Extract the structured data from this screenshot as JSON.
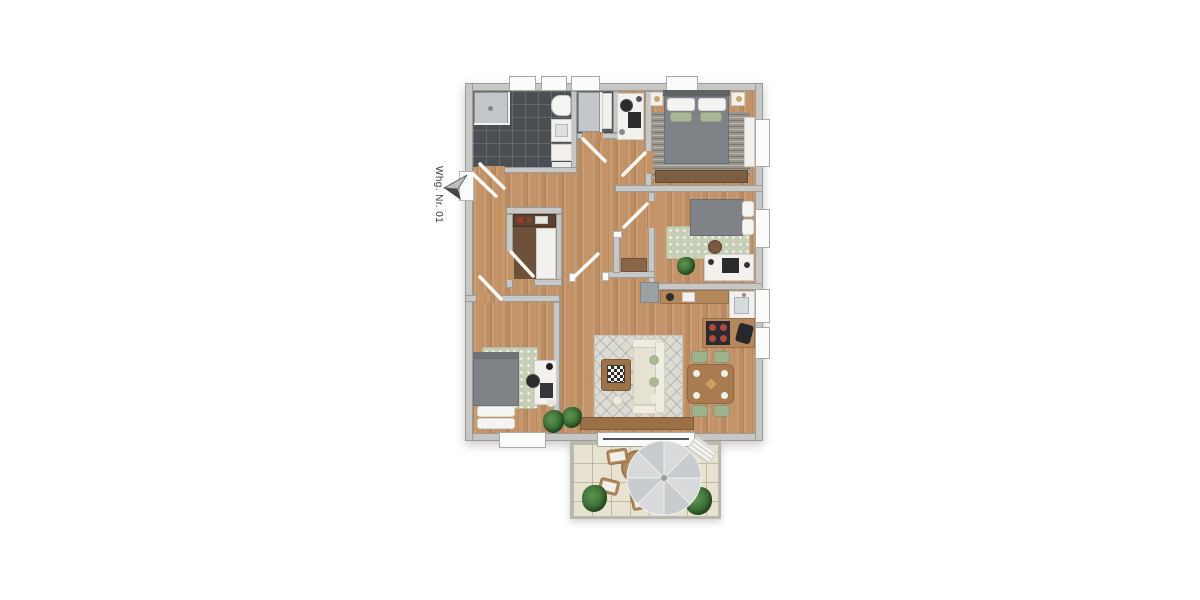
{
  "labels": {
    "apartment": "Whg. Nr. 01"
  },
  "icons": {
    "entrance_arrow": "entrance-direction-arrow"
  },
  "palette": {
    "background": "#ffffff",
    "wall": "#c7c7c6",
    "wall_edge": "#9b9b99",
    "wood_floor": "#c49367",
    "bath_tile": "#4a4f53",
    "terrace_tile": "#e8e2d1",
    "rug_sage": "#c6ceb5",
    "rug_gray": "#9a968c",
    "rug_living": "#dcdbd4",
    "duvet_gray": "#7f8387",
    "pillow_green": "#aab795",
    "sofa_cream": "#efece0",
    "furniture_wood": "#b5885c",
    "dining_chair_green": "#9fb28e",
    "cooktop_burner": "#b14a3e",
    "plant_green": "#35662f",
    "label_text": "#3b3b3b"
  },
  "rooms": [
    {
      "name": "bathroom-1",
      "features": [
        "shower",
        "toilet",
        "vanity"
      ]
    },
    {
      "name": "bathroom-2",
      "features": [
        "shower",
        "vanity"
      ]
    },
    {
      "name": "office-nook",
      "features": [
        "desk",
        "chair",
        "monitor"
      ]
    },
    {
      "name": "bedroom-1",
      "features": [
        "double-bed",
        "nightstands",
        "wardrobe",
        "dresser",
        "rug"
      ]
    },
    {
      "name": "bedroom-2",
      "features": [
        "bed",
        "desk",
        "chair",
        "rug",
        "plant"
      ]
    },
    {
      "name": "bedroom-3",
      "features": [
        "bed",
        "desk",
        "chair",
        "rug",
        "plant"
      ]
    },
    {
      "name": "hallway",
      "features": [
        "storage-closet",
        "sideboard",
        "wardrobe"
      ]
    },
    {
      "name": "living-dining-kitchen",
      "features": [
        "sofa",
        "coffee-table",
        "rug",
        "tv-bench",
        "dining-table",
        "dining-chairs",
        "kitchen-counter",
        "sink",
        "cooktop",
        "fridge"
      ]
    },
    {
      "name": "terrace",
      "features": [
        "parasol",
        "round-table",
        "chairs",
        "lounger",
        "plants"
      ]
    }
  ]
}
